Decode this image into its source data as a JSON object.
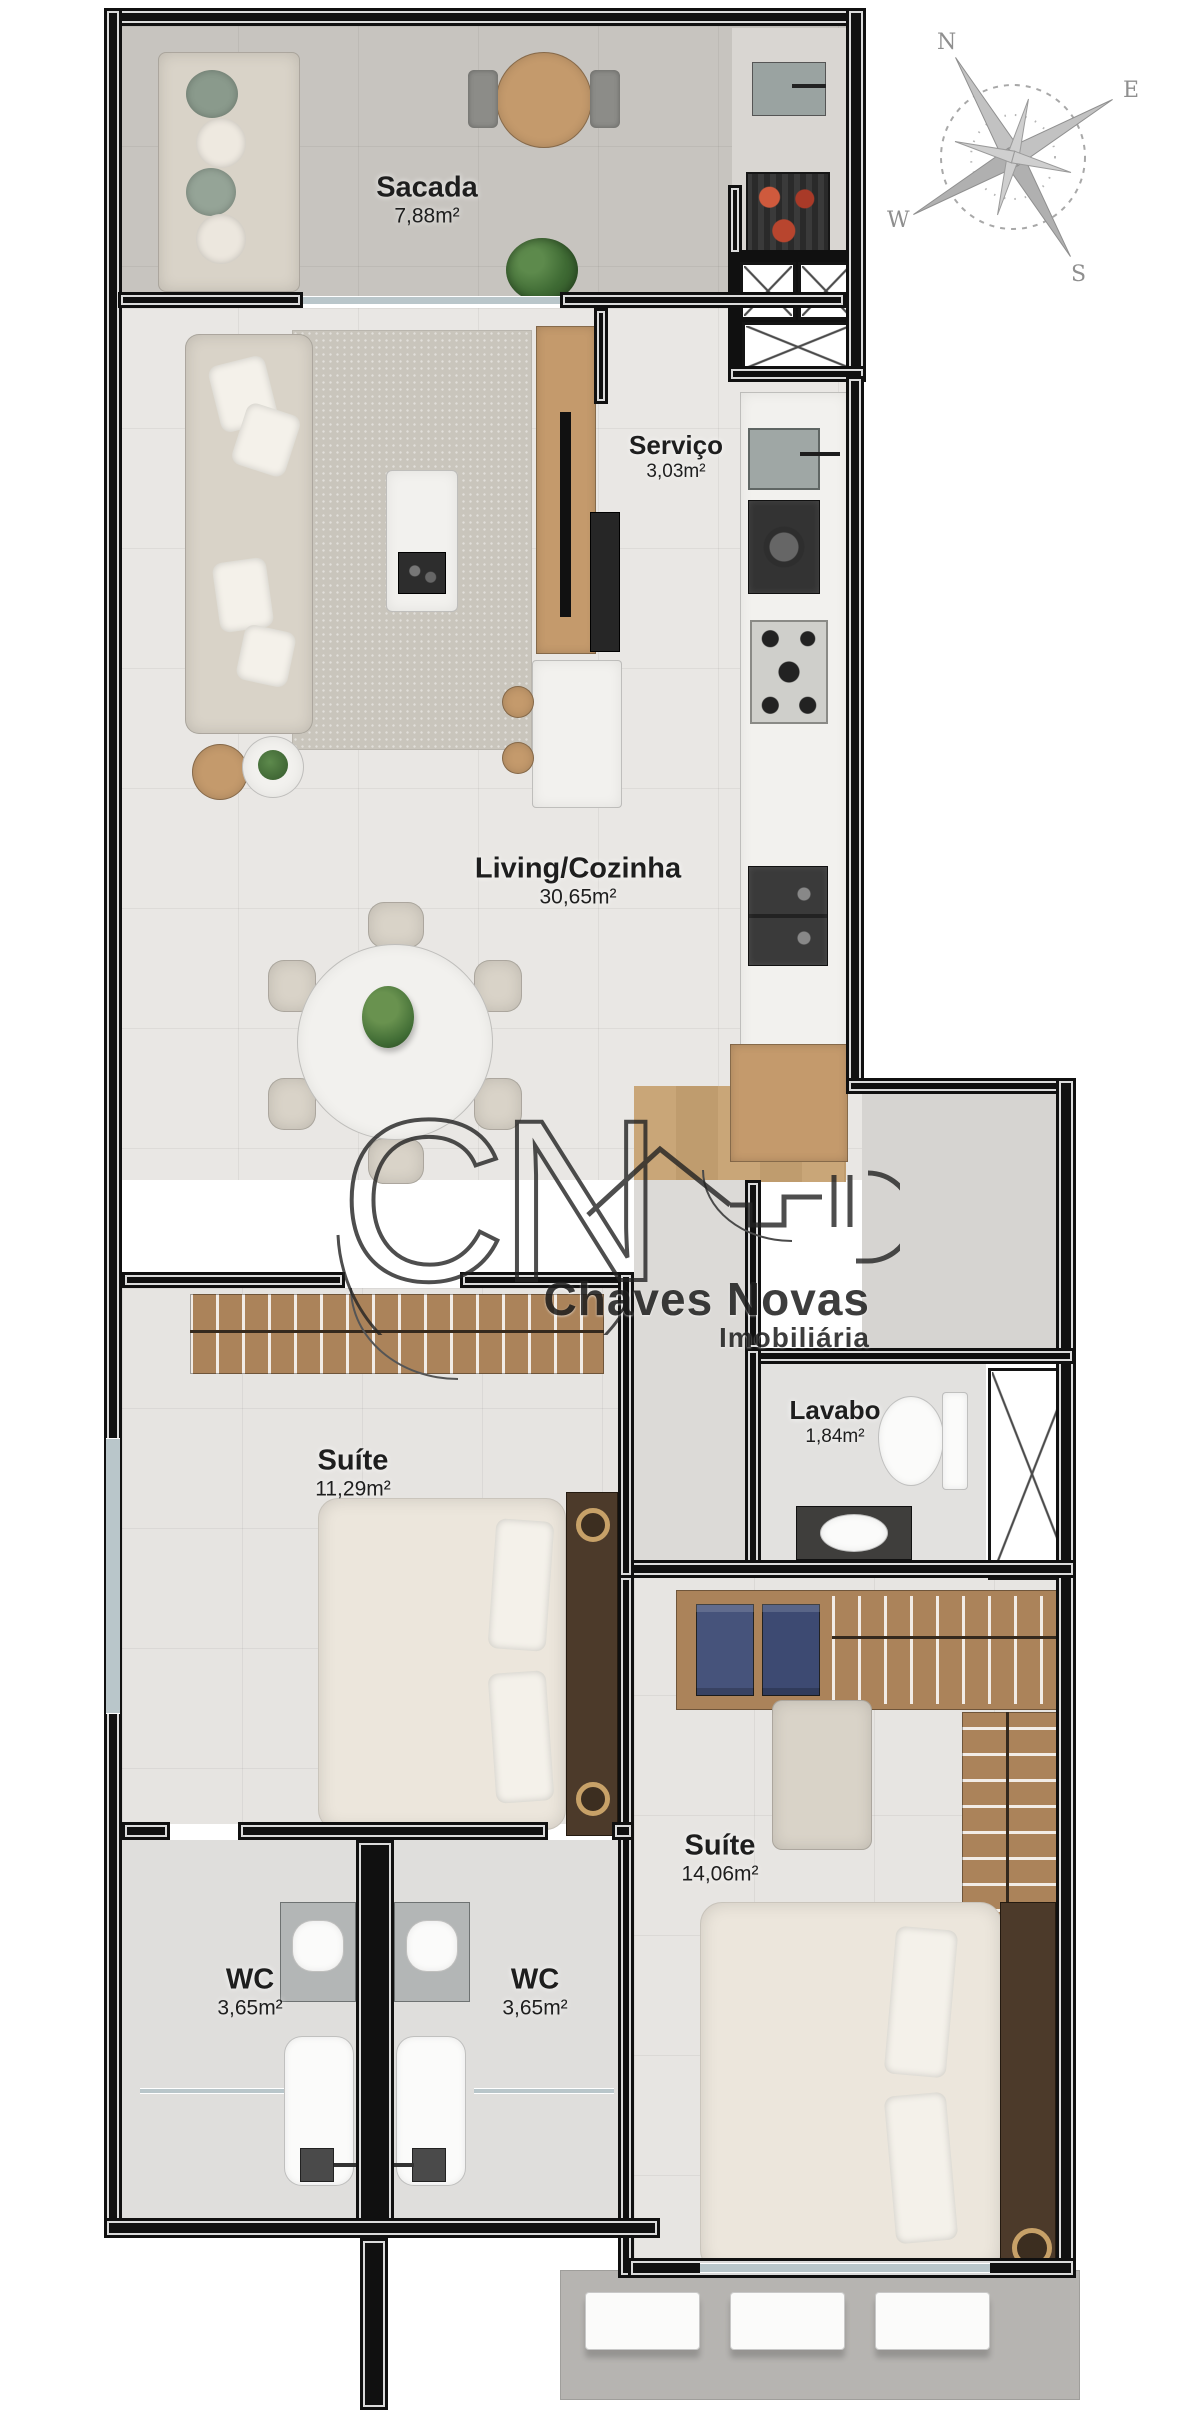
{
  "plan": {
    "rooms": [
      {
        "name": "Sacada",
        "area": "7,88m²"
      },
      {
        "name": "Serviço",
        "area": "3,03m²"
      },
      {
        "name": "Living/Cozinha",
        "area": "30,65m²"
      },
      {
        "name": "Suíte",
        "area": "11,29m²"
      },
      {
        "name": "Lavabo",
        "area": "1,84m²"
      },
      {
        "name": "Suíte",
        "area": "14,06m²"
      },
      {
        "name": "WC",
        "area": "3,65m²"
      },
      {
        "name": "WC",
        "area": "3,65m²"
      }
    ],
    "compass": {
      "n": "N",
      "e": "E",
      "s": "S",
      "w": "W"
    },
    "watermark": {
      "initials": "CN",
      "line1": "Chaves Novas",
      "line2": "Imobiliária"
    }
  },
  "palette": {
    "wall": "#101010",
    "wood": "#b98e5f",
    "floor_light": "#e9e7e4",
    "floor_balcony": "#c7c4bf",
    "coal_red": "#b23a2a",
    "glass": "#b9c6ca"
  }
}
